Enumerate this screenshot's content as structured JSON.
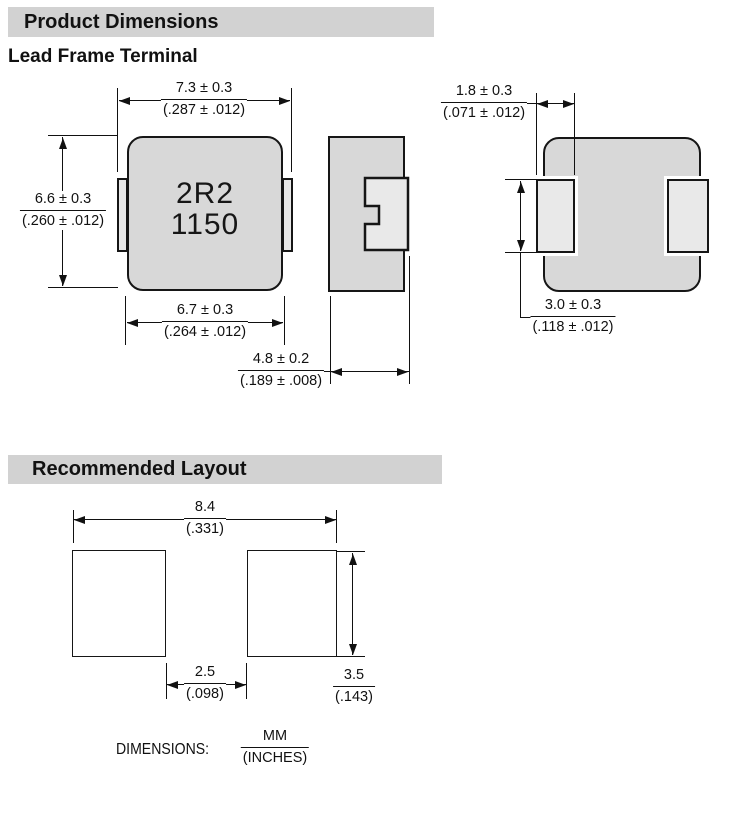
{
  "headers": {
    "product_dimensions": "Product Dimensions",
    "lead_frame_terminal": "Lead Frame Terminal",
    "recommended_layout": "Recommended Layout"
  },
  "part_marking": {
    "line1": "2R2",
    "line2": "1150"
  },
  "dims": {
    "body_width_top": {
      "mm": "7.3 ± 0.3",
      "in": "(.287 ± .012)"
    },
    "body_height": {
      "mm": "6.6 ± 0.3",
      "in": "(.260 ± .012)"
    },
    "body_width_bottom": {
      "mm": "6.7 ± 0.3",
      "in": "(.264 ± .012)"
    },
    "body_thickness": {
      "mm": "4.8 ± 0.2",
      "in": "(.189 ± .008)"
    },
    "terminal_width": {
      "mm": "1.8 ± 0.3",
      "in": "(.071 ± .012)"
    },
    "terminal_height": {
      "mm": "3.0 ± 0.3",
      "in": "(.118 ± .012)"
    }
  },
  "layout_dims": {
    "pad_outer_span": {
      "mm": "8.4",
      "in": "(.331)"
    },
    "pad_gap": {
      "mm": "2.5",
      "in": "(.098)"
    },
    "pad_height": {
      "mm": "3.5",
      "in": "(.143)"
    }
  },
  "note": {
    "label": "DIMENSIONS:",
    "numerator": "MM",
    "denominator": "(INCHES)"
  },
  "colors": {
    "component_body": "#d8d8d8",
    "terminal_pad": "#e9e9e9",
    "header_bg": "#d2d2d2",
    "line": "#111111"
  }
}
